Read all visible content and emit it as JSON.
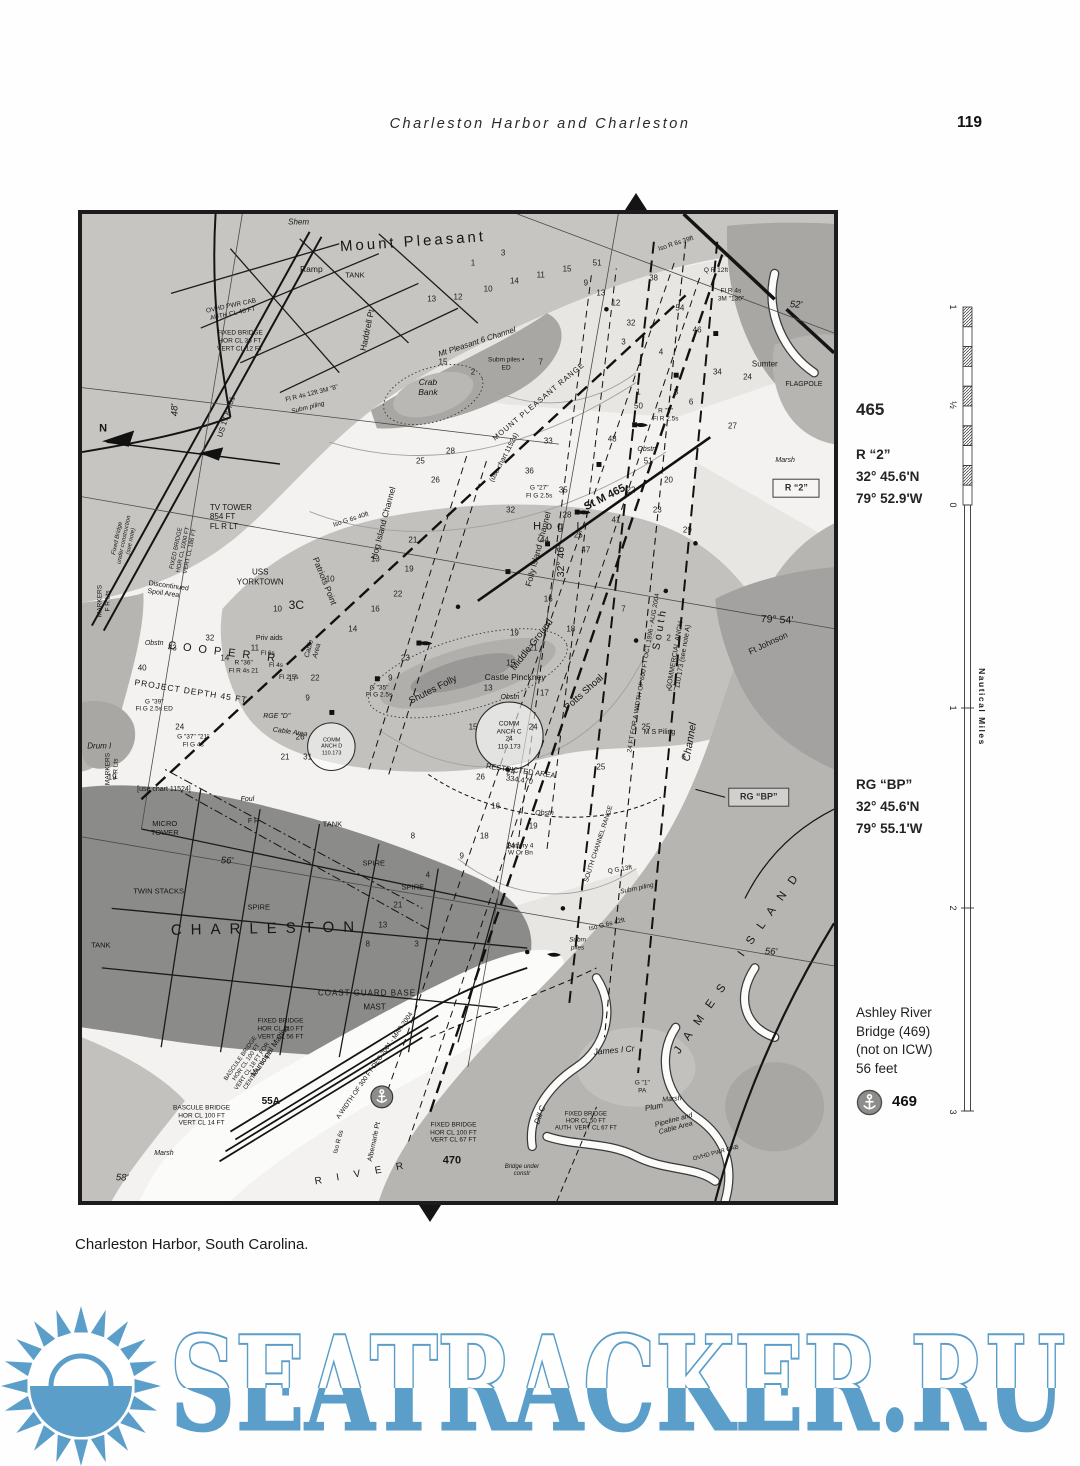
{
  "header": {
    "title": "Charleston Harbor and Charleston",
    "page_number": "119"
  },
  "caption": "Charleston Harbor, South Carolina.",
  "watermark": {
    "text": "SEATRACKER.RU",
    "color": "#5b9ec9"
  },
  "sidebar": {
    "chart_number": "465",
    "mark1": {
      "name": "R “2”",
      "lat": "32° 45.6'N",
      "lon": "79° 52.9'W"
    },
    "mark2": {
      "name": "RG “BP”",
      "lat": "32° 45.6'N",
      "lon": "79° 55.1'W"
    },
    "bridge": {
      "l1": "Ashley River",
      "l2": "Bridge (469)",
      "l3": "(not on ICW)",
      "l4": "56 feet",
      "badge": "469"
    }
  },
  "scale": {
    "title": "Nautical Miles",
    "labels": [
      [
        "1",
        307
      ],
      [
        "½",
        405
      ],
      [
        "0",
        505
      ],
      [
        "1",
        708
      ],
      [
        "2",
        908
      ],
      [
        "3",
        1112
      ]
    ]
  },
  "map": {
    "labels": [
      [
        "Mount Pleasant",
        44,
        2.8,
        -4,
        15,
        "ls3"
      ],
      [
        "TANK",
        36.3,
        6.3,
        0,
        7.5,
        ""
      ],
      [
        "Ramp",
        30.5,
        5.6,
        0,
        8.5,
        ""
      ],
      [
        "Shem",
        28.8,
        0.8,
        0,
        8,
        "it"
      ],
      [
        "Haddrell Pt",
        37.9,
        11.8,
        -78,
        8.5,
        ""
      ],
      [
        "Crab\nBank",
        46,
        17.5,
        0,
        8.5,
        "it ctr"
      ],
      [
        "Hog I",
        63.4,
        31.7,
        0,
        11,
        "ls5"
      ],
      [
        "USS\nYORKTOWN",
        23.7,
        36.8,
        0,
        8,
        "ctr"
      ],
      [
        "Patriots Point",
        32.3,
        37.2,
        68,
        8.5,
        ""
      ],
      [
        "3C",
        28.5,
        39.6,
        0,
        12,
        ""
      ],
      [
        "COOPER R",
        19,
        44.5,
        7,
        11,
        "ls7"
      ],
      [
        "PROJECT DEPTH 45 FT",
        14.5,
        48.3,
        9,
        8.5,
        "ls1"
      ],
      [
        "TV TOWER\n854 FT\nFL R LT",
        19.8,
        30.7,
        0,
        8,
        ""
      ],
      [
        "48'",
        12.4,
        19.9,
        -90,
        9.5,
        "it"
      ],
      [
        "N",
        2.8,
        21.8,
        0,
        11,
        "b"
      ],
      [
        "US 17 & 701",
        19.3,
        20.6,
        -72,
        7.5,
        ""
      ],
      [
        "Discontinued\nSpoil Area",
        11.4,
        38.2,
        8,
        7,
        ""
      ],
      [
        "MARKERS\nF R Lts",
        2.9,
        39.2,
        -90,
        6.5,
        "ctr"
      ],
      [
        "Shutes Folly",
        46.7,
        48.2,
        -27,
        9.5,
        ""
      ],
      [
        "Castle Pinckney",
        57.6,
        46.9,
        0,
        8.5,
        ""
      ],
      [
        "Middle Ground",
        59.9,
        43.7,
        -52,
        9.5,
        ""
      ],
      [
        "Potts Shoal",
        66.7,
        48.5,
        -42,
        9.5,
        ""
      ],
      [
        "COMM\nANCH C\n24\n110.173",
        56.8,
        52.9,
        0,
        6.5,
        "ctr"
      ],
      [
        "COMM\nANCH D\n110.173",
        33.2,
        54,
        0,
        5.5,
        "ctr"
      ],
      [
        "RESTRICTED AREA\n334.470",
        58.2,
        56.9,
        8,
        7.5,
        "ctr"
      ],
      [
        "South",
        76.8,
        42,
        -80,
        10.5,
        "ls3"
      ],
      [
        "COMMERCIAL ANCH\n110.173 (see note A)",
        79.5,
        44.8,
        -80,
        7,
        "ctr"
      ],
      [
        "24 FT FOR A WIDTH OF 600 FT OCT 1996 - AUG 2004",
        74.8,
        46.5,
        -80,
        6.5,
        ""
      ],
      [
        "Channel",
        80.8,
        53.5,
        -80,
        10.5,
        "it"
      ],
      [
        "St M 465",
        69.5,
        28.8,
        -27,
        11,
        "b"
      ],
      [
        "32° 46'",
        63.7,
        35.2,
        -90,
        10.5,
        ""
      ],
      [
        "Folly Island Channel",
        60.7,
        33.9,
        -75,
        8.5,
        ""
      ],
      [
        "(use chart 11524)",
        56.2,
        24.7,
        -62,
        7,
        ""
      ],
      [
        "MOUNT PLEASANT RANGE",
        60.8,
        19,
        -40,
        7.5,
        "ls1"
      ],
      [
        "79° 54'",
        92.4,
        41.1,
        3,
        10.5,
        ""
      ],
      [
        "Ft Johnson",
        91.2,
        43.5,
        -25,
        8.5,
        ""
      ],
      [
        "I S L A N D",
        91.5,
        71,
        -55,
        11.5,
        "ls4"
      ],
      [
        "J A M E S",
        82.5,
        81.5,
        -55,
        11.5,
        "ls4"
      ],
      [
        "56'",
        91.6,
        74.8,
        3,
        9.5,
        "it"
      ],
      [
        "56'",
        19.3,
        65.6,
        3,
        9.5,
        "it"
      ],
      [
        "CHARLESTON",
        24.6,
        72.4,
        -1,
        15,
        "ls8"
      ],
      [
        "TWIN STACKS",
        10.2,
        68.7,
        0,
        7.5,
        ""
      ],
      [
        "SPIRE",
        23.5,
        70.3,
        0,
        7.5,
        ""
      ],
      [
        "SPIRE",
        38.8,
        65.9,
        0,
        7.5,
        ""
      ],
      [
        "SPIRE",
        44,
        68.3,
        0,
        7.5,
        ""
      ],
      [
        "TANK",
        2.5,
        74.2,
        0,
        7.5,
        ""
      ],
      [
        "TANK",
        33.3,
        61.9,
        0,
        7.5,
        ""
      ],
      [
        "F R",
        22.8,
        61.6,
        0,
        7,
        ""
      ],
      [
        "MICRO\nTOWER",
        11,
        62.3,
        0,
        7.5,
        "ctr"
      ],
      [
        "COAST GUARD BASE",
        37.9,
        78.9,
        0,
        8,
        "ls1"
      ],
      [
        "MAST",
        38.9,
        80.3,
        0,
        8,
        ""
      ],
      [
        "FIXED BRIDGE\nHOR CL 110 FT\nVERT CL 56 FT",
        26.4,
        82.6,
        0,
        6.5,
        "ctr"
      ],
      [
        "Municipal Marina",
        25,
        84.8,
        -55,
        8,
        ""
      ],
      [
        "BASCULE BRIDGE\nHOR CL 100 FT\nVERT CL 18 FT FOR\nCENTRAL 50 FT",
        22.3,
        86.2,
        -55,
        6,
        "ctr"
      ],
      [
        "BASCULE BRIDGE\nHOR CL 100 FT\nVERT CL 14 FT",
        15.9,
        91.4,
        0,
        6.5,
        "ctr"
      ],
      [
        "55A",
        25.1,
        90,
        0,
        10,
        "b"
      ],
      [
        "Marsh",
        10.9,
        95.2,
        0,
        7,
        "it"
      ],
      [
        "58'",
        5.3,
        97.7,
        3,
        9.5,
        "it"
      ],
      [
        "A WIDTH OF 300 FT DEC 2001 - MAR 2004",
        38.9,
        86.3,
        -55,
        6.5,
        ""
      ],
      [
        "R I V E R",
        37.2,
        97.3,
        -10,
        10,
        "ls6"
      ],
      [
        "Albemarle Pt",
        38.9,
        94,
        -78,
        7,
        ""
      ],
      [
        "470",
        49.2,
        95.9,
        0,
        11,
        "b"
      ],
      [
        "FIXED BRIDGE\nHOR CL 100 FT\nVERT CL 67 FT",
        49.4,
        93.1,
        0,
        6.5,
        "ctr"
      ],
      [
        "FIXED BRIDGE\nHOR CL 50 FT\nAUTH  VERT CL 67 FT",
        67,
        92,
        0,
        6,
        "ctr"
      ],
      [
        "Bridge under\nconstr",
        58.5,
        97,
        0,
        6,
        "ctr it"
      ],
      [
        "James I Cr",
        70.7,
        84.7,
        -5,
        8.5,
        "it"
      ],
      [
        "Plum",
        76,
        90.5,
        -10,
        8,
        "it"
      ],
      [
        "Dill C",
        60.9,
        91.3,
        -70,
        8,
        "it"
      ],
      [
        "Pipeline and\nCable Area",
        78.9,
        92.3,
        -15,
        7,
        "ctr it"
      ],
      [
        "OVHD PWR CAB",
        84.3,
        95.2,
        -15,
        6,
        ""
      ],
      [
        "OVHD PWR CAB\nAUTH CL 40 FT",
        20,
        9.7,
        -12,
        6.5,
        "ctr"
      ],
      [
        "FIXED BRIDGE\nHOR CL 36 FT\nVERT CL 12 FT",
        21,
        12.9,
        0,
        6.5,
        "ctr"
      ],
      [
        "FLAGPOLE",
        96,
        17.3,
        0,
        7,
        ""
      ],
      [
        "Sumter",
        90.8,
        15.2,
        0,
        8,
        ""
      ],
      [
        "Marsh",
        93.5,
        25,
        0,
        7,
        "it"
      ],
      [
        "R \"2\"\nFl R 2.5s",
        77.6,
        20.4,
        0,
        6.5,
        "ctr"
      ],
      [
        "G \"27\"\nFl G 2.5s",
        60.8,
        28.2,
        0,
        6.5,
        "ctr"
      ],
      [
        "Iso G 6s 40ft",
        35.8,
        31,
        -18,
        6.5,
        ""
      ],
      [
        "Mt Pleasant 6 Channel",
        52.5,
        13,
        -18,
        8,
        "it"
      ],
      [
        "Subm piles •\nED",
        56.4,
        15.2,
        0,
        6.5,
        "ctr"
      ],
      [
        "Fl R 4s 12ft 3M \"8\"",
        30.6,
        18.2,
        -14,
        6.5,
        ""
      ],
      [
        "Subm piling",
        30,
        19.7,
        -14,
        6.5,
        "it"
      ],
      [
        "M S Piling",
        76.8,
        52.6,
        0,
        7,
        ""
      ],
      [
        "RGE \"D\"",
        25.9,
        51,
        0,
        7,
        "it"
      ],
      [
        "Cable Area",
        27.7,
        52.6,
        8,
        7,
        "it"
      ],
      [
        "Cable\nArea",
        30.9,
        44.2,
        -75,
        7,
        "ctr it"
      ],
      [
        "Priv aids",
        24.9,
        43.1,
        0,
        7,
        ""
      ],
      [
        "Fl 6s",
        24.7,
        44.6,
        0,
        6.5,
        ""
      ],
      [
        "Fl 4s",
        25.8,
        45.8,
        0,
        6.5,
        ""
      ],
      [
        "Fl 2.5s",
        27.5,
        47,
        0,
        6.5,
        ""
      ],
      [
        "Battery 4\nW Or Bn",
        58.3,
        64.4,
        0,
        6.5,
        "ctr"
      ],
      [
        "SOUTH CHANNEL RANGE",
        68.8,
        63.8,
        -72,
        6.5,
        ""
      ],
      [
        "Q G 13ft",
        71.5,
        66.5,
        -10,
        6.5,
        ""
      ],
      [
        "Subm piling",
        73.8,
        68.4,
        -12,
        6.5,
        "it"
      ],
      [
        "Iso G 6s 42ft",
        69.8,
        72,
        -14,
        6.5,
        ""
      ],
      [
        "Subm\npiles",
        65.9,
        74,
        0,
        6.5,
        "ctr it"
      ],
      [
        "Iso R 6s 39ft",
        79,
        3,
        -18,
        6.5,
        ""
      ],
      [
        "Q R 12ft",
        84.3,
        5.8,
        0,
        6.5,
        ""
      ],
      [
        "Fl R 4s\n3M \"130\"",
        86.3,
        8.2,
        0,
        6.5,
        "ctr"
      ],
      [
        "52'",
        95,
        9.2,
        3,
        9.5,
        "it"
      ],
      [
        "G \"35\"\nFl G 2.5s",
        39.5,
        48.4,
        0,
        6.5,
        "ctr"
      ],
      [
        "R \"36\"\nFl R 4s 21",
        21.5,
        45.9,
        0,
        6.5,
        "ctr"
      ],
      [
        "G \"39\"\nFl G 2.5s ED",
        9.6,
        49.8,
        0,
        6.5,
        "ctr"
      ],
      [
        "G \"37\" \"21\"\nFl G 4s",
        14.8,
        53.4,
        0,
        6.5,
        "ctr"
      ],
      [
        "Obstn",
        9.6,
        43.6,
        0,
        7,
        "it"
      ],
      [
        "Obstn",
        56.9,
        49,
        0,
        7,
        "it"
      ],
      [
        "Obstn",
        75.1,
        23.9,
        0,
        7,
        "it"
      ],
      [
        "Obstn",
        61.5,
        60.8,
        0,
        7,
        "it"
      ],
      [
        "[use chart 11524]",
        10.9,
        58.4,
        0,
        7,
        ""
      ],
      [
        "Foul",
        22,
        59.4,
        0,
        7,
        "it"
      ],
      [
        "Hog Island Channel",
        40,
        31.3,
        -75,
        8.5,
        ""
      ],
      [
        "Drum I",
        2.3,
        53.9,
        0,
        8,
        "it"
      ],
      [
        "MARKERS\nF R Lts",
        4,
        56.2,
        -90,
        6.5,
        "ctr"
      ],
      [
        "Fixed Bridge\nunder construction\n(see note)",
        5.7,
        33,
        -78,
        6,
        "ctr it"
      ],
      [
        "FIXED BRIDGE\nHOR CL 1000 FT\nVERT CL 186 FT",
        13.6,
        34,
        -78,
        6,
        "ctr"
      ],
      [
        "Iso R 6s",
        34.2,
        94,
        -75,
        6.5,
        ""
      ],
      [
        "G \"1\"\nPA",
        74.5,
        88.5,
        0,
        6.5,
        "ctr"
      ],
      [
        "Marsh",
        78.5,
        89.8,
        -5,
        7,
        "it"
      ],
      [
        "R “2”",
        95,
        27.8,
        0,
        9,
        "bx"
      ],
      [
        "RG “BP”",
        90,
        59.1,
        0,
        9,
        "bx"
      ]
    ],
    "soundings": [
      [
        13,
        46.5,
        8.6
      ],
      [
        12,
        50,
        8.4
      ],
      [
        10,
        54,
        7.6
      ],
      [
        14,
        57.5,
        6.8
      ],
      [
        11,
        61,
        6.2
      ],
      [
        15,
        64.5,
        5.6
      ],
      [
        9,
        67,
        7
      ],
      [
        13,
        69,
        8
      ],
      [
        12,
        71,
        9
      ],
      [
        32,
        73,
        11
      ],
      [
        38,
        76,
        6.5
      ],
      [
        54,
        79.5,
        9.5
      ],
      [
        46,
        81.8,
        11.8
      ],
      [
        51,
        68.5,
        5
      ],
      [
        50,
        74,
        19.5
      ],
      [
        48,
        70.5,
        22.8
      ],
      [
        51,
        75.3,
        25
      ],
      [
        34,
        84.5,
        16
      ],
      [
        27,
        86.5,
        21.5
      ],
      [
        24,
        88.5,
        16.5
      ],
      [
        41,
        71,
        31
      ],
      [
        47,
        67,
        34
      ],
      [
        44,
        61.5,
        33
      ],
      [
        32,
        57,
        30
      ],
      [
        35,
        64,
        28
      ],
      [
        36,
        59.5,
        26
      ],
      [
        33,
        62,
        23
      ],
      [
        28,
        64.5,
        30.5
      ],
      [
        25,
        66,
        32.5
      ],
      [
        22,
        73,
        28
      ],
      [
        23,
        76.5,
        30
      ],
      [
        20,
        78,
        27
      ],
      [
        29,
        80.5,
        32
      ],
      [
        16,
        62,
        39
      ],
      [
        18,
        65,
        42
      ],
      [
        21,
        60,
        44
      ],
      [
        19,
        57.5,
        42.5
      ],
      [
        15,
        57,
        45.5
      ],
      [
        13,
        54,
        48
      ],
      [
        17,
        61.5,
        48.5
      ],
      [
        24,
        60,
        52
      ],
      [
        24,
        57,
        56.5
      ],
      [
        25,
        75,
        52
      ],
      [
        27,
        78.5,
        48
      ],
      [
        15,
        52,
        52
      ],
      [
        26,
        53,
        57
      ],
      [
        16,
        55,
        60
      ],
      [
        19,
        60,
        62
      ],
      [
        14,
        57,
        64
      ],
      [
        18,
        53.5,
        63
      ],
      [
        9,
        50.5,
        65
      ],
      [
        4,
        46,
        67
      ],
      [
        8,
        44,
        63
      ],
      [
        21,
        42,
        70
      ],
      [
        13,
        40,
        72
      ],
      [
        8,
        38,
        74
      ],
      [
        3,
        44.5,
        74
      ],
      [
        25,
        69,
        56
      ],
      [
        6,
        80,
        55
      ],
      [
        2,
        78,
        43
      ],
      [
        7,
        72,
        40
      ],
      [
        43,
        12,
        44
      ],
      [
        40,
        8,
        46
      ],
      [
        32,
        17,
        43
      ],
      [
        19,
        4,
        57
      ],
      [
        24,
        13,
        52
      ],
      [
        14,
        19,
        45
      ],
      [
        17,
        28,
        47
      ],
      [
        22,
        31,
        47
      ],
      [
        9,
        30,
        49
      ],
      [
        26,
        29,
        53
      ],
      [
        31,
        30,
        55
      ],
      [
        21,
        27,
        55
      ],
      [
        7,
        61,
        15
      ],
      [
        3,
        72,
        13
      ],
      [
        1,
        74,
        18
      ],
      [
        4,
        77,
        14
      ],
      [
        8,
        79,
        18
      ],
      [
        6,
        81,
        19
      ],
      [
        23,
        43,
        45
      ],
      [
        10,
        26,
        40
      ],
      [
        11,
        23,
        44
      ],
      [
        15,
        48,
        15
      ],
      [
        2,
        52,
        16
      ],
      [
        28,
        49,
        24
      ],
      [
        26,
        47,
        27
      ],
      [
        25,
        45,
        25
      ],
      [
        21,
        44,
        33
      ],
      [
        19,
        43.5,
        36
      ],
      [
        22,
        42,
        38.5
      ],
      [
        13,
        39,
        35
      ],
      [
        14,
        36,
        42
      ],
      [
        10,
        33,
        37
      ],
      [
        9,
        41,
        47
      ],
      [
        16,
        39,
        40
      ],
      [
        1,
        52,
        5
      ],
      [
        3,
        56,
        4
      ]
    ]
  }
}
